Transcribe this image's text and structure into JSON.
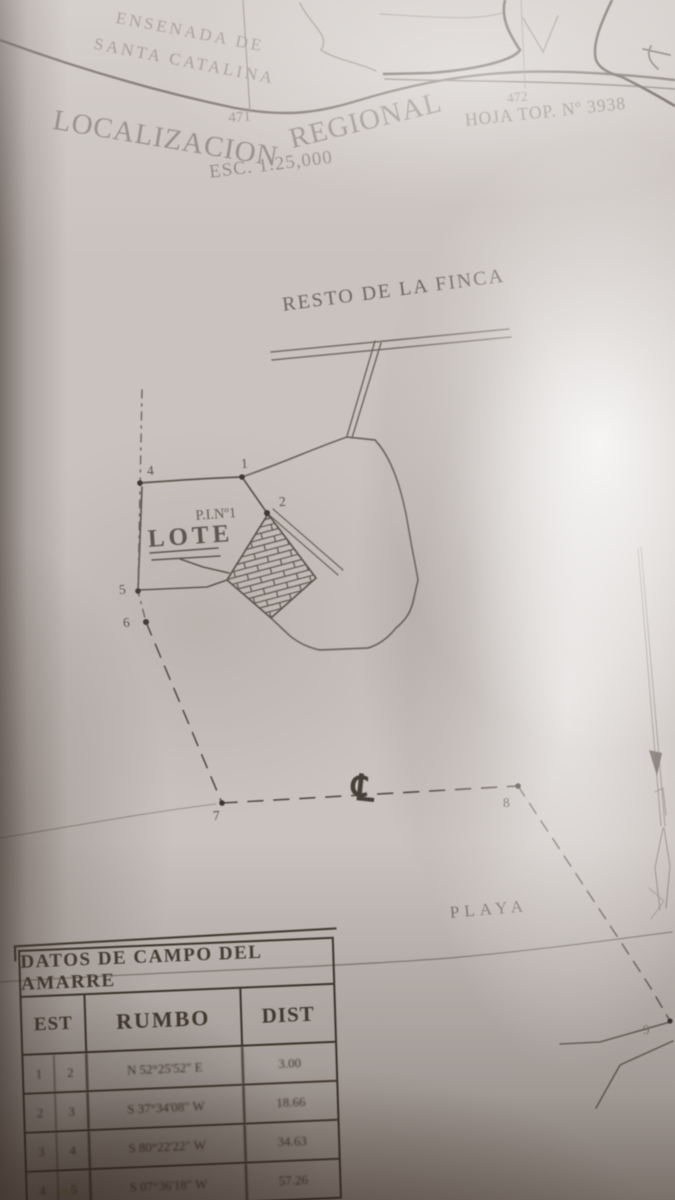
{
  "header": {
    "bay_line1": "ENSENADA DE",
    "bay_line2": "SANTA CATALINA",
    "grid_left": "471",
    "grid_right": "472",
    "title_part1": "LOCALIZACION",
    "title_part2": "REGIONAL",
    "scale": "ESC. 1:25,000",
    "topo_sheet": "HOJA TOP. Nº 3938"
  },
  "plan": {
    "resto": "RESTO DE LA FINCA",
    "pi": "P.I.Nº1",
    "lote": "LOTE",
    "playa": "PLAYA",
    "centerline": "℄",
    "points": {
      "p1": "1",
      "p2": "2",
      "p4": "4",
      "p5": "5",
      "p6": "6",
      "p7": "7",
      "p8": "8",
      "p9": "9"
    }
  },
  "table": {
    "title": "DATOS DE CAMPO DEL AMARRE",
    "col_est": "EST",
    "col_rumbo": "RUMBO",
    "col_dist": "DIST",
    "rows": [
      {
        "from": "1",
        "to": "2",
        "rumbo": "N 52°25'52\" E",
        "dist": "3.00"
      },
      {
        "from": "2",
        "to": "3",
        "rumbo": "S 37°34'08\" W",
        "dist": "18.66"
      },
      {
        "from": "3",
        "to": "4",
        "rumbo": "S 80°22'22\" W",
        "dist": "34.63"
      },
      {
        "from": "4",
        "to": "5",
        "rumbo": "S 07°36'18\" W",
        "dist": "57.26"
      }
    ]
  },
  "colors": {
    "ink": "#5d534d",
    "faded_ink": "#8a817b",
    "paper": "#c9c2be"
  }
}
